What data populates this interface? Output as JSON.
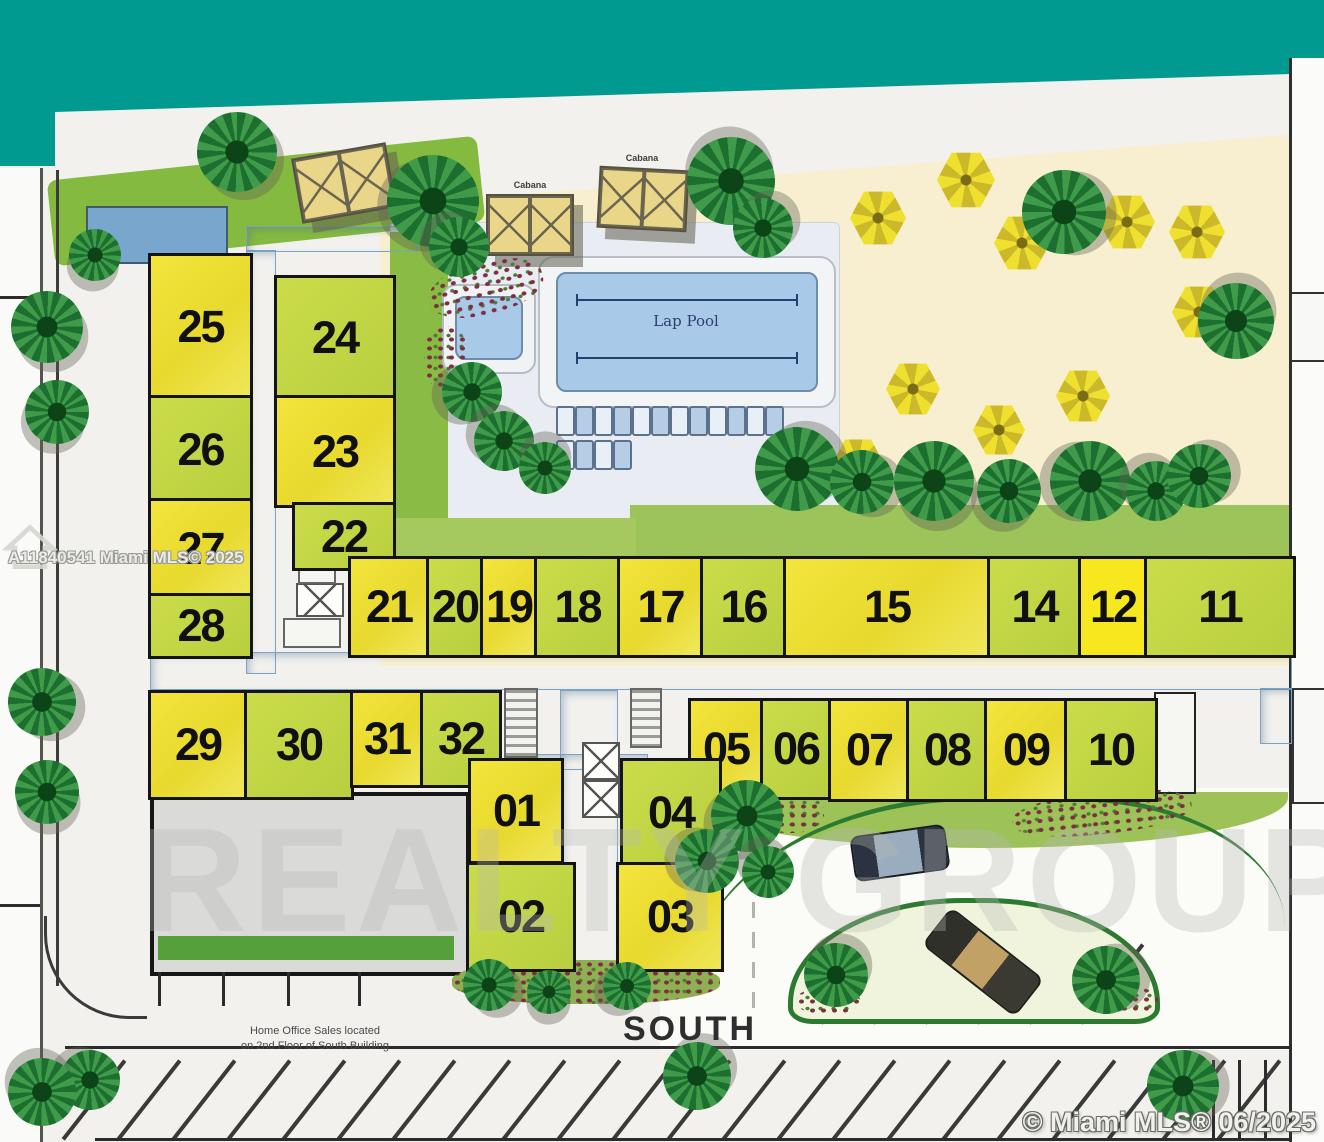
{
  "title": "Condominium site plan",
  "palette": {
    "ocean": "#019a90",
    "sand": "#f7efcf",
    "boardwalk": "#e2c37c",
    "unit_yellow": "#f0e23a",
    "unit_green": "#c6d944",
    "corridor_blue": "#9cc2de",
    "pool_water": "#a9c9e9",
    "grass": "#85ba40",
    "building_gray": "#dadad8",
    "umbrella_yellow": "#efe02f",
    "palm_green": "#2f8f3e"
  },
  "labels": {
    "lap_pool": "Lap Pool",
    "cabana": "Cabana",
    "south": "SOUTH",
    "home_office_line1": "Home Office Sales located",
    "home_office_line2": "on 2nd Floor of South Building"
  },
  "watermarks": {
    "left": "A11840541 Miami MLS© 2025",
    "bottom_right": "© Miami MLS® 06/2025",
    "realty": "REALTY GROUP"
  },
  "units": [
    {
      "n": "25",
      "x": 148,
      "y": 253,
      "w": 99,
      "h": 142,
      "c": "uy"
    },
    {
      "n": "26",
      "x": 148,
      "y": 395,
      "w": 99,
      "h": 103,
      "c": "ug"
    },
    {
      "n": "27",
      "x": 148,
      "y": 498,
      "w": 99,
      "h": 95,
      "c": "uy"
    },
    {
      "n": "28",
      "x": 148,
      "y": 593,
      "w": 99,
      "h": 60,
      "c": "ug"
    },
    {
      "n": "24",
      "x": 274,
      "y": 275,
      "w": 116,
      "h": 120,
      "c": "ug"
    },
    {
      "n": "23",
      "x": 274,
      "y": 395,
      "w": 116,
      "h": 107,
      "c": "uy"
    },
    {
      "n": "22",
      "x": 292,
      "y": 502,
      "w": 98,
      "h": 63,
      "c": "ug"
    },
    {
      "n": "21",
      "x": 348,
      "y": 556,
      "w": 76,
      "h": 96,
      "c": "uy"
    },
    {
      "n": "20",
      "x": 426,
      "y": 556,
      "w": 52,
      "h": 96,
      "c": "ug"
    },
    {
      "n": "19",
      "x": 480,
      "y": 556,
      "w": 52,
      "h": 96,
      "c": "uy"
    },
    {
      "n": "18",
      "x": 534,
      "y": 556,
      "w": 81,
      "h": 96,
      "c": "ug"
    },
    {
      "n": "17",
      "x": 617,
      "y": 556,
      "w": 81,
      "h": 96,
      "c": "uy"
    },
    {
      "n": "16",
      "x": 700,
      "y": 556,
      "w": 81,
      "h": 96,
      "c": "ug"
    },
    {
      "n": "15",
      "x": 783,
      "y": 556,
      "w": 202,
      "h": 96,
      "c": "uy"
    },
    {
      "n": "14",
      "x": 987,
      "y": 556,
      "w": 89,
      "h": 96,
      "c": "ug"
    },
    {
      "n": "12",
      "x": 1078,
      "y": 556,
      "w": 64,
      "h": 96,
      "c": "uy2"
    },
    {
      "n": "11",
      "x": 1144,
      "y": 556,
      "w": 146,
      "h": 96,
      "c": "ug"
    },
    {
      "n": "29",
      "x": 148,
      "y": 690,
      "w": 94,
      "h": 104,
      "c": "uy"
    },
    {
      "n": "30",
      "x": 244,
      "y": 690,
      "w": 104,
      "h": 104,
      "c": "ug"
    },
    {
      "n": "31",
      "x": 350,
      "y": 690,
      "w": 68,
      "h": 92,
      "c": "uy"
    },
    {
      "n": "32",
      "x": 420,
      "y": 690,
      "w": 76,
      "h": 92,
      "c": "ug"
    },
    {
      "n": "05",
      "x": 688,
      "y": 698,
      "w": 70,
      "h": 96,
      "c": "uy"
    },
    {
      "n": "06",
      "x": 760,
      "y": 698,
      "w": 66,
      "h": 96,
      "c": "ug"
    },
    {
      "n": "07",
      "x": 828,
      "y": 698,
      "w": 76,
      "h": 98,
      "c": "uy"
    },
    {
      "n": "08",
      "x": 906,
      "y": 698,
      "w": 76,
      "h": 98,
      "c": "ug"
    },
    {
      "n": "09",
      "x": 984,
      "y": 698,
      "w": 78,
      "h": 98,
      "c": "uy"
    },
    {
      "n": "10",
      "x": 1064,
      "y": 698,
      "w": 88,
      "h": 98,
      "c": "ug"
    },
    {
      "n": "01",
      "x": 468,
      "y": 758,
      "w": 90,
      "h": 100,
      "c": "uy"
    },
    {
      "n": "04",
      "x": 620,
      "y": 758,
      "w": 96,
      "h": 104,
      "c": "ug"
    },
    {
      "n": "02",
      "x": 466,
      "y": 862,
      "w": 104,
      "h": 104,
      "c": "ug"
    },
    {
      "n": "03",
      "x": 616,
      "y": 862,
      "w": 102,
      "h": 104,
      "c": "uy"
    }
  ],
  "scene": {
    "regions": [
      {
        "name": "ocean",
        "x": 0,
        "y": 0,
        "w": 1324,
        "h": 172,
        "bg": "#019a90",
        "clip": "polygon(0px 0px,1324px 0px,1324px 73px,55px 112px,55px 166px,0px 166px)",
        "z": 1
      },
      {
        "name": "boardwalk",
        "x": 55,
        "y": 62,
        "w": 1269,
        "h": 172,
        "cls": "boardwalk",
        "clip": "polygon(0px 50px,1269px 11px,1269px 74px,0px 168px)",
        "z": 1
      },
      {
        "name": "sand-area",
        "x": 380,
        "y": 120,
        "w": 944,
        "h": 546,
        "bg": "#f7efcf",
        "clip": "polygon(0px 85px,944px 12px,944px 546px,0px 546px)",
        "z": 1
      },
      {
        "name": "sand-blue-patch",
        "x": 820,
        "y": 235,
        "w": 330,
        "h": 300,
        "cls": "sandblue",
        "z": 1
      },
      {
        "name": "top-lawn",
        "x": 50,
        "y": 158,
        "w": 432,
        "h": 86,
        "bg": "#85ba40",
        "rot": -6,
        "radius": "10px",
        "z": 1
      },
      {
        "name": "pool-deck",
        "x": 390,
        "y": 222,
        "w": 448,
        "h": 302,
        "bg": "#e9edf3",
        "radius": "6px",
        "border": "1px solid #ccd5dd",
        "z": 1
      },
      {
        "name": "courtyard-green",
        "x": 390,
        "y": 232,
        "w": 58,
        "h": 330,
        "bg": "#8abc45",
        "z": 2
      },
      {
        "name": "hedge-mid",
        "x": 630,
        "y": 505,
        "w": 662,
        "h": 52,
        "bg": "#9cc45a",
        "z": 2
      },
      {
        "name": "green-strip-21",
        "x": 396,
        "y": 518,
        "w": 240,
        "h": 40,
        "bg": "#a5c95e",
        "z": 2
      },
      {
        "name": "left-road",
        "x": 0,
        "y": 168,
        "w": 42,
        "h": 974,
        "bg": "#fafaf8",
        "z": 1
      },
      {
        "name": "left-road-curb",
        "x": 40,
        "y": 168,
        "w": 3,
        "h": 974,
        "bg": "#555550",
        "z": 2
      },
      {
        "name": "left-boundary",
        "x": 56,
        "y": 170,
        "w": 3,
        "h": 816,
        "bg": "#3c3c3c",
        "z": 2
      },
      {
        "name": "right-road",
        "x": 1292,
        "y": 58,
        "w": 32,
        "h": 1084,
        "bg": "#fbfbf9",
        "z": 2
      },
      {
        "name": "right-boundary",
        "x": 1289,
        "y": 58,
        "w": 3,
        "h": 1084,
        "bg": "#2f2f2f",
        "z": 3
      },
      {
        "name": "entry-drive",
        "x": 660,
        "y": 788,
        "w": 630,
        "h": 262,
        "bg": "#fbfbf8",
        "z": 2
      },
      {
        "name": "drive-green-band",
        "x": 688,
        "y": 792,
        "w": 600,
        "h": 56,
        "bg": "#9dc258",
        "radius": "0 0 50% 50% / 0 0 90% 90%",
        "z": 3
      },
      {
        "name": "drive-curb-arc",
        "x": 688,
        "y": 796,
        "w": 597,
        "h": 212,
        "cls": "curb-arc",
        "bg": "transparent",
        "z": 3
      },
      {
        "name": "parking-island-crescent",
        "x": 788,
        "y": 898,
        "w": 362,
        "h": 116,
        "bg": "#f0f4dc",
        "border": "5px solid #2c7a30",
        "radius": "175px 175px 24px 24px / 105px 105px 16px 16px",
        "z": 4
      },
      {
        "name": "south-building",
        "x": 150,
        "y": 792,
        "w": 312,
        "h": 176,
        "bg": "#dadad8",
        "border": "4px solid #161616",
        "cls": "roof",
        "z": 4
      },
      {
        "name": "balcony-strip",
        "x": 158,
        "y": 936,
        "w": 296,
        "h": 24,
        "bg": "#55a03a",
        "cls": "gstripes",
        "z": 5
      },
      {
        "name": "corridor-nw",
        "x": 246,
        "y": 250,
        "w": 30,
        "h": 424,
        "cls": "corridor",
        "z": 3
      },
      {
        "name": "corridor-nw-top",
        "x": 246,
        "y": 226,
        "w": 172,
        "h": 26,
        "cls": "corridor",
        "z": 3
      },
      {
        "name": "corridor-main",
        "x": 150,
        "y": 652,
        "w": 1142,
        "h": 38,
        "cls": "corridor",
        "z": 3
      },
      {
        "name": "corridor-right-stub",
        "x": 1260,
        "y": 688,
        "w": 32,
        "h": 56,
        "cls": "corridor",
        "z": 3
      },
      {
        "name": "corridor-south",
        "x": 560,
        "y": 690,
        "w": 58,
        "h": 300,
        "cls": "corridor",
        "z": 3
      },
      {
        "name": "corridor-south-stub",
        "x": 530,
        "y": 754,
        "w": 118,
        "h": 16,
        "cls": "corridor",
        "z": 3
      },
      {
        "name": "pool-pad",
        "x": 538,
        "y": 256,
        "w": 294,
        "h": 148,
        "bg": "#f2f4f6",
        "radius": "16px",
        "border": "2px solid #b9bfc6",
        "z": 4
      },
      {
        "name": "lap-pool-water",
        "x": 556,
        "y": 272,
        "w": 258,
        "h": 116,
        "bg": "#a9c9e9",
        "radius": "10px",
        "border": "2px solid #6d8cab",
        "z": 5
      },
      {
        "name": "spa-pad",
        "x": 442,
        "y": 284,
        "w": 90,
        "h": 86,
        "bg": "#f0f2f4",
        "radius": "14px",
        "border": "2px solid #b5bbc2",
        "z": 4
      },
      {
        "name": "spa-water",
        "x": 455,
        "y": 296,
        "w": 64,
        "h": 60,
        "bg": "#a9c9e9",
        "radius": "10px",
        "border": "2px solid #6d8cab",
        "z": 5
      },
      {
        "name": "beach-mat",
        "x": 86,
        "y": 206,
        "w": 138,
        "h": 54,
        "bg": "#79a6cd",
        "border": "2px solid #44586e",
        "cls": "hlines",
        "z": 4
      },
      {
        "name": "right-edge-box-1",
        "x": 1290,
        "y": 292,
        "w": 32,
        "h": 66,
        "bg": "#f8f8f6",
        "border": "2px solid #333",
        "z": 4
      },
      {
        "name": "right-edge-box-2",
        "x": 1292,
        "y": 688,
        "w": 30,
        "h": 112,
        "bg": "#f8f8f6",
        "border": "2px solid #333",
        "z": 4
      },
      {
        "name": "unit10-utility",
        "x": 1154,
        "y": 692,
        "w": 38,
        "h": 98,
        "bg": "#f6f6f2",
        "border": "2px solid #222",
        "z": 4
      },
      {
        "name": "parking-corner-arc",
        "x": 44,
        "y": 916,
        "w": 100,
        "h": 100,
        "cls": "corner-arc",
        "bg": "transparent",
        "z": 5
      }
    ],
    "palms": [
      [
        237,
        152,
        40
      ],
      [
        95,
        255,
        26
      ],
      [
        433,
        201,
        46
      ],
      [
        459,
        247,
        30
      ],
      [
        731,
        181,
        44
      ],
      [
        763,
        228,
        30
      ],
      [
        1064,
        212,
        42
      ],
      [
        47,
        327,
        36
      ],
      [
        57,
        412,
        32
      ],
      [
        472,
        392,
        30
      ],
      [
        504,
        441,
        30
      ],
      [
        545,
        468,
        26
      ],
      [
        797,
        469,
        42
      ],
      [
        862,
        482,
        32
      ],
      [
        934,
        481,
        40
      ],
      [
        1009,
        491,
        32
      ],
      [
        1090,
        481,
        40
      ],
      [
        1156,
        491,
        30
      ],
      [
        1236,
        321,
        38
      ],
      [
        1199,
        476,
        32
      ],
      [
        42,
        702,
        34
      ],
      [
        47,
        792,
        32
      ],
      [
        747,
        816,
        36
      ],
      [
        707,
        861,
        32
      ],
      [
        768,
        872,
        26
      ],
      [
        836,
        975,
        32
      ],
      [
        1106,
        980,
        34
      ],
      [
        489,
        985,
        26
      ],
      [
        549,
        992,
        22
      ],
      [
        627,
        986,
        24
      ],
      [
        90,
        1080,
        30
      ],
      [
        42,
        1092,
        34
      ],
      [
        697,
        1076,
        34
      ],
      [
        1183,
        1086,
        36
      ]
    ],
    "umbrellas": [
      [
        878,
        218,
        56
      ],
      [
        966,
        180,
        58
      ],
      [
        1022,
        243,
        56
      ],
      [
        1127,
        222,
        56
      ],
      [
        1197,
        232,
        56
      ],
      [
        1199,
        312,
        54
      ],
      [
        913,
        389,
        54
      ],
      [
        999,
        430,
        52
      ],
      [
        1083,
        396,
        54
      ],
      [
        858,
        464,
        52
      ]
    ],
    "cabanas": [
      [
        296,
        150,
        92,
        62,
        -10
      ],
      [
        486,
        194,
        84,
        58,
        0
      ],
      [
        598,
        168,
        86,
        58,
        3
      ]
    ],
    "chair_rows": [
      {
        "x": 556,
        "y": 406,
        "n": 12,
        "step": 19
      },
      {
        "x": 556,
        "y": 440,
        "n": 4,
        "step": 19
      }
    ],
    "xboxes": [
      [
        296,
        583,
        44,
        30
      ],
      [
        582,
        742,
        34,
        34
      ],
      [
        582,
        780,
        34,
        34
      ]
    ],
    "stripe_boxes": [
      [
        504,
        688,
        30,
        66
      ],
      [
        630,
        688,
        28,
        56
      ]
    ],
    "plain_boxes": [
      [
        298,
        552,
        34,
        28
      ],
      [
        283,
        618,
        54,
        26
      ]
    ],
    "flower_beds": [
      [
        428,
        262,
        116,
        52,
        -14,
        false
      ],
      [
        424,
        326,
        44,
        64,
        0,
        false
      ],
      [
        754,
        793,
        70,
        40,
        0,
        false
      ],
      [
        1012,
        792,
        180,
        42,
        -6,
        false
      ],
      [
        688,
        843,
        48,
        38,
        0,
        false
      ],
      [
        452,
        960,
        268,
        44,
        0,
        true
      ],
      [
        796,
        988,
        64,
        26,
        0,
        false
      ],
      [
        1086,
        986,
        72,
        28,
        0,
        false
      ]
    ],
    "cars": [
      {
        "x": 852,
        "y": 830,
        "w": 92,
        "h": 42,
        "rot": -8,
        "kind": "sedan"
      },
      {
        "x": 924,
        "y": 938,
        "w": 114,
        "h": 44,
        "rot": 38,
        "kind": "truck"
      }
    ],
    "parking": {
      "lines": [
        [
          65,
          1046,
          1227,
          3
        ],
        [
          95,
          1138,
          1197,
          3
        ],
        [
          0,
          296,
          40,
          3
        ],
        [
          0,
          904,
          40,
          3
        ],
        [
          158,
          972,
          3,
          34
        ],
        [
          222,
          972,
          3,
          34
        ],
        [
          287,
          972,
          3,
          34
        ],
        [
          358,
          972,
          3,
          34
        ],
        [
          1212,
          1060,
          3,
          80
        ],
        [
          1238,
          1060,
          3,
          80
        ],
        [
          1264,
          1060,
          3,
          80
        ],
        [
          752,
          812,
          3,
          198,
          "dash"
        ]
      ],
      "diag_rows": [
        {
          "x0": 92,
          "y0": 1050,
          "step": 55,
          "n": 22,
          "len": 100,
          "rot": 38
        },
        {
          "x0": 850,
          "y0": 934,
          "step": 52,
          "n": 6,
          "len": 100,
          "rot": 38
        }
      ]
    },
    "dim_lines": [
      [
        576,
        294,
        218
      ],
      [
        576,
        352,
        218
      ]
    ]
  }
}
